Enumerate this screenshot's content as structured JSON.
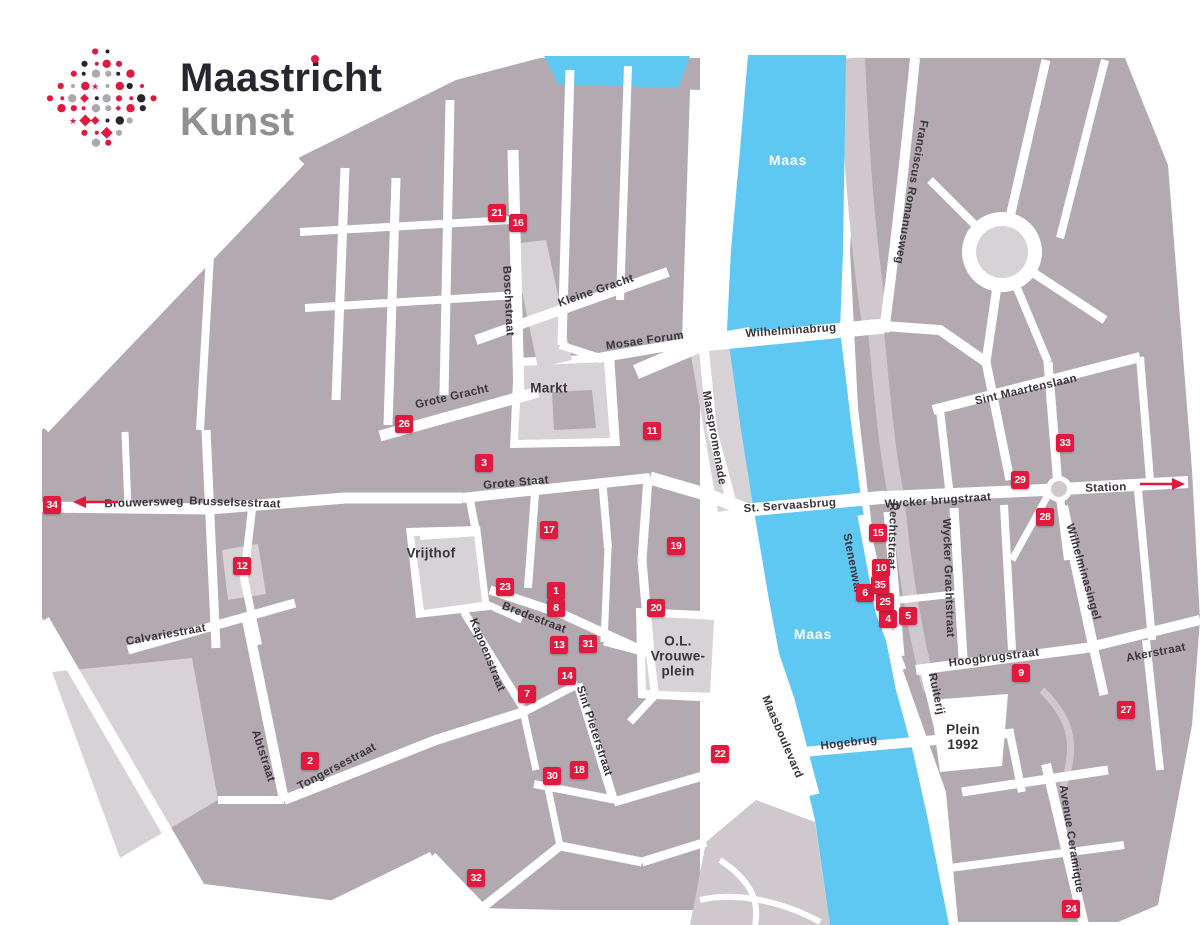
{
  "logo": {
    "title": "Maastricht",
    "subtitle": "Kunst"
  },
  "palette": {
    "block": "#b3aab1",
    "block_light": "#d7d2d6",
    "band_light": "#cfc9ce",
    "river": "#5ec7f2",
    "marker_red": "#df1a3e",
    "label_dark": "#39333b",
    "logo_dark": "#26262e",
    "logo_gray": "#8f8f94",
    "logo_dot_black": "#26252b",
    "logo_dot_gray": "#a9a9ae"
  },
  "map": {
    "labels": [
      {
        "text": "Maas",
        "x": 788,
        "y": 160,
        "rot": 0,
        "kind": "river"
      },
      {
        "text": "Maas",
        "x": 813,
        "y": 634,
        "rot": 0,
        "kind": "river"
      },
      {
        "text": "Wilhelminabrug",
        "x": 791,
        "y": 331,
        "rot": -4,
        "kind": "street"
      },
      {
        "text": "Franciscus Romanusweg",
        "x": 911,
        "y": 192,
        "rot": 100,
        "kind": "street"
      },
      {
        "text": "Kleine Gracht",
        "x": 596,
        "y": 291,
        "rot": -19,
        "kind": "street"
      },
      {
        "text": "Mosae Forum",
        "x": 645,
        "y": 341,
        "rot": -8,
        "kind": "street"
      },
      {
        "text": "Boschstraat",
        "x": 508,
        "y": 301,
        "rot": 87,
        "kind": "street"
      },
      {
        "text": "Markt",
        "x": 549,
        "y": 388,
        "rot": 0,
        "kind": "area"
      },
      {
        "text": "Grote Gracht",
        "x": 452,
        "y": 397,
        "rot": -13,
        "kind": "street"
      },
      {
        "text": "Grote Staat",
        "x": 516,
        "y": 483,
        "rot": -5,
        "kind": "street"
      },
      {
        "text": "St. Servaasbrug",
        "x": 790,
        "y": 506,
        "rot": -4,
        "kind": "street"
      },
      {
        "text": "Wycker brugstraat",
        "x": 938,
        "y": 501,
        "rot": -4,
        "kind": "street"
      },
      {
        "text": "Station",
        "x": 1106,
        "y": 488,
        "rot": -2,
        "kind": "street"
      },
      {
        "text": "Sint Maartenslaan",
        "x": 1026,
        "y": 390,
        "rot": -13,
        "kind": "street"
      },
      {
        "text": "Brouwersweg",
        "x": 144,
        "y": 503,
        "rot": -2,
        "kind": "street"
      },
      {
        "text": "Brusselsestraat",
        "x": 235,
        "y": 503,
        "rot": 2,
        "kind": "street"
      },
      {
        "text": "Vrijthof",
        "x": 431,
        "y": 553,
        "rot": 0,
        "kind": "area"
      },
      {
        "text": "Bredestraat",
        "x": 534,
        "y": 618,
        "rot": 21,
        "kind": "street"
      },
      {
        "text": "Kapoenstraat",
        "x": 487,
        "y": 655,
        "rot": 68,
        "kind": "street"
      },
      {
        "text": "Calvariestraat",
        "x": 166,
        "y": 635,
        "rot": -10,
        "kind": "street"
      },
      {
        "text": "Sint Pieterstraat",
        "x": 594,
        "y": 731,
        "rot": 72,
        "kind": "street"
      },
      {
        "text": "Abtstraat",
        "x": 263,
        "y": 756,
        "rot": 72,
        "kind": "street"
      },
      {
        "text": "Tongersestraat",
        "x": 337,
        "y": 767,
        "rot": -28,
        "kind": "street"
      },
      {
        "text": "Maasboulevard",
        "x": 782,
        "y": 737,
        "rot": 67,
        "kind": "street"
      },
      {
        "text": "Hogebrug",
        "x": 849,
        "y": 743,
        "rot": -7,
        "kind": "street"
      },
      {
        "text": "Plein\n1992",
        "x": 963,
        "y": 737,
        "rot": 0,
        "kind": "area"
      },
      {
        "text": "Hoogbrugstraat",
        "x": 994,
        "y": 658,
        "rot": -7,
        "kind": "street"
      },
      {
        "text": "Akerstraat",
        "x": 1156,
        "y": 653,
        "rot": -11,
        "kind": "street"
      },
      {
        "text": "Ruiterij",
        "x": 936,
        "y": 694,
        "rot": 78,
        "kind": "street"
      },
      {
        "text": "Wycker Grachtstraat",
        "x": 948,
        "y": 578,
        "rot": 88,
        "kind": "street"
      },
      {
        "text": "Rechtstraat",
        "x": 892,
        "y": 536,
        "rot": 92,
        "kind": "street"
      },
      {
        "text": "Stenenwal",
        "x": 852,
        "y": 563,
        "rot": 79,
        "kind": "street"
      },
      {
        "text": "Wilhelminasingel",
        "x": 1083,
        "y": 572,
        "rot": 74,
        "kind": "street"
      },
      {
        "text": "Avenue Ceramique",
        "x": 1071,
        "y": 839,
        "rot": 81,
        "kind": "street"
      },
      {
        "text": "Maaspromenade",
        "x": 714,
        "y": 438,
        "rot": 80,
        "kind": "street"
      },
      {
        "text": "O.L.\nVrouwe-\nplein",
        "x": 678,
        "y": 656,
        "rot": 0,
        "kind": "area"
      }
    ],
    "markers": [
      {
        "n": 1,
        "x": 556,
        "y": 591
      },
      {
        "n": 2,
        "x": 310,
        "y": 761
      },
      {
        "n": 3,
        "x": 484,
        "y": 463
      },
      {
        "n": 4,
        "x": 888,
        "y": 619
      },
      {
        "n": 5,
        "x": 908,
        "y": 616
      },
      {
        "n": 6,
        "x": 865,
        "y": 593
      },
      {
        "n": 7,
        "x": 527,
        "y": 694
      },
      {
        "n": 8,
        "x": 556,
        "y": 608
      },
      {
        "n": 9,
        "x": 1021,
        "y": 673
      },
      {
        "n": 10,
        "x": 881,
        "y": 568
      },
      {
        "n": 11,
        "x": 652,
        "y": 431
      },
      {
        "n": 12,
        "x": 242,
        "y": 566
      },
      {
        "n": 13,
        "x": 559,
        "y": 645
      },
      {
        "n": 14,
        "x": 567,
        "y": 676
      },
      {
        "n": 15,
        "x": 878,
        "y": 533
      },
      {
        "n": 16,
        "x": 518,
        "y": 223
      },
      {
        "n": 17,
        "x": 549,
        "y": 530
      },
      {
        "n": 18,
        "x": 579,
        "y": 770
      },
      {
        "n": 19,
        "x": 676,
        "y": 546
      },
      {
        "n": 20,
        "x": 656,
        "y": 608
      },
      {
        "n": 21,
        "x": 497,
        "y": 213
      },
      {
        "n": 22,
        "x": 720,
        "y": 754
      },
      {
        "n": 23,
        "x": 505,
        "y": 587
      },
      {
        "n": 24,
        "x": 1071,
        "y": 909
      },
      {
        "n": 25,
        "x": 885,
        "y": 602
      },
      {
        "n": 26,
        "x": 404,
        "y": 424
      },
      {
        "n": 27,
        "x": 1126,
        "y": 710
      },
      {
        "n": 28,
        "x": 1045,
        "y": 517
      },
      {
        "n": 29,
        "x": 1020,
        "y": 480
      },
      {
        "n": 30,
        "x": 552,
        "y": 776
      },
      {
        "n": 31,
        "x": 588,
        "y": 644
      },
      {
        "n": 32,
        "x": 476,
        "y": 878
      },
      {
        "n": 33,
        "x": 1065,
        "y": 443
      },
      {
        "n": 34,
        "x": 52,
        "y": 505
      },
      {
        "n": 35,
        "x": 880,
        "y": 585
      }
    ],
    "arrows": [
      {
        "dir": "left",
        "x": 96,
        "y": 502
      },
      {
        "dir": "right",
        "x": 1162,
        "y": 484
      }
    ]
  }
}
